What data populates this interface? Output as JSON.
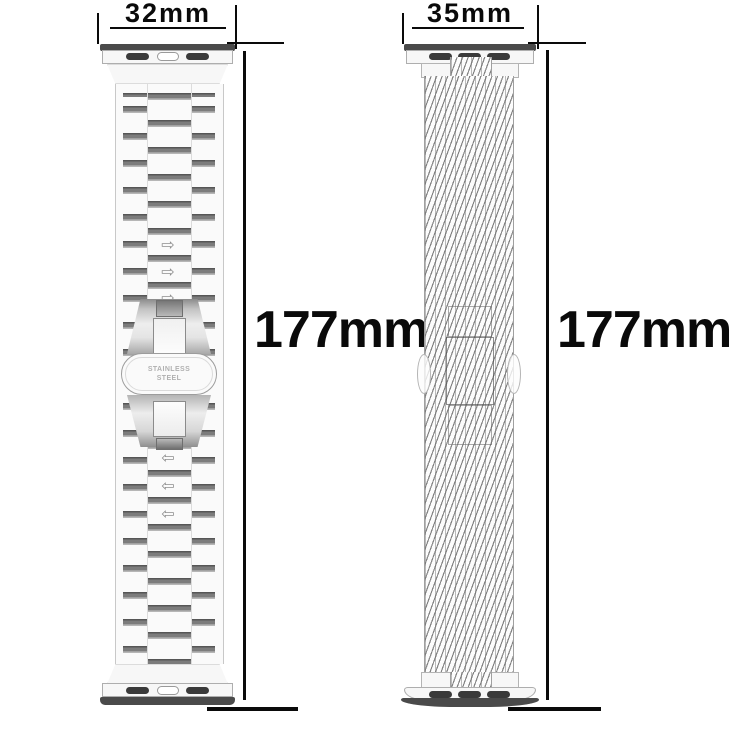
{
  "figure": {
    "type": "watch band size diagram",
    "background": "#ffffff",
    "dimension_line_color": "#0a0a0a"
  },
  "bands": [
    {
      "side": "left",
      "style": "stainless-steel-link-bracelet",
      "width_label": "32mm",
      "length_label": "177mm",
      "clasp_engraving_line1": "STAINLESS",
      "clasp_engraving_line2": "STEEL",
      "arrow_right_glyph": "⇨",
      "arrow_left_glyph": "⇦"
    },
    {
      "side": "right",
      "style": "woven-mesh-loop",
      "width_label": "35mm",
      "length_label": "177mm"
    }
  ]
}
